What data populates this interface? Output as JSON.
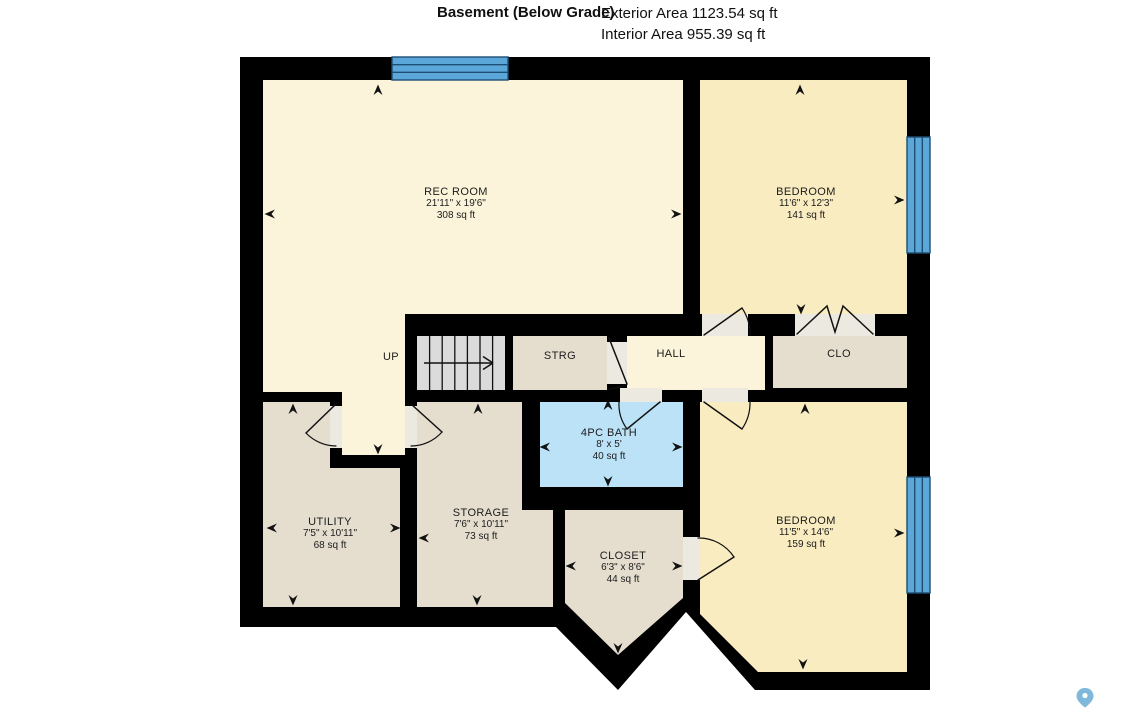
{
  "header": {
    "title": "Basement (Below Grade)",
    "exterior_area": "Exterior Area 1123.54 sq ft",
    "interior_area": "Interior Area 955.39 sq ft"
  },
  "rooms": {
    "rec_room": {
      "name": "REC ROOM",
      "dims": "21'11\" x 19'6\"",
      "area": "308 sq ft"
    },
    "bedroom_top": {
      "name": "BEDROOM",
      "dims": "11'6\" x 12'3\"",
      "area": "141 sq ft"
    },
    "bedroom_bottom": {
      "name": "BEDROOM",
      "dims": "11'5\" x 14'6\"",
      "area": "159 sq ft"
    },
    "bath": {
      "name": "4PC BATH",
      "dims": "8' x 5'",
      "area": "40 sq ft"
    },
    "utility": {
      "name": "UTILITY",
      "dims": "7'5\" x 10'11\"",
      "area": "68 sq ft"
    },
    "storage": {
      "name": "STORAGE",
      "dims": "7'6\" x 10'11\"",
      "area": "73 sq ft"
    },
    "closet": {
      "name": "CLOSET",
      "dims": "6'3\" x 8'6\"",
      "area": "44 sq ft"
    },
    "hall": {
      "name": "HALL"
    },
    "strg": {
      "name": "STRG"
    },
    "clo": {
      "name": "CLO"
    },
    "stairs": {
      "label": "UP"
    }
  },
  "colors": {
    "wall": "#000000",
    "living_cream": "#FBF4DA",
    "bedroom_yellow": "#F9ECC1",
    "service_beige": "#E5DECF",
    "bath_blue": "#BCE2F7",
    "window_blue": "#5CA7DA",
    "window_line": "#1D4E74",
    "stairs_gray": "#DBDBDB",
    "door_gap": "#ECE9E0",
    "pin_blue": "#7FB8DB"
  },
  "icons": {
    "location_pin": "map-pin",
    "dimension_marker": "small-arrowhead",
    "stairs_direction": "right-arrow"
  }
}
